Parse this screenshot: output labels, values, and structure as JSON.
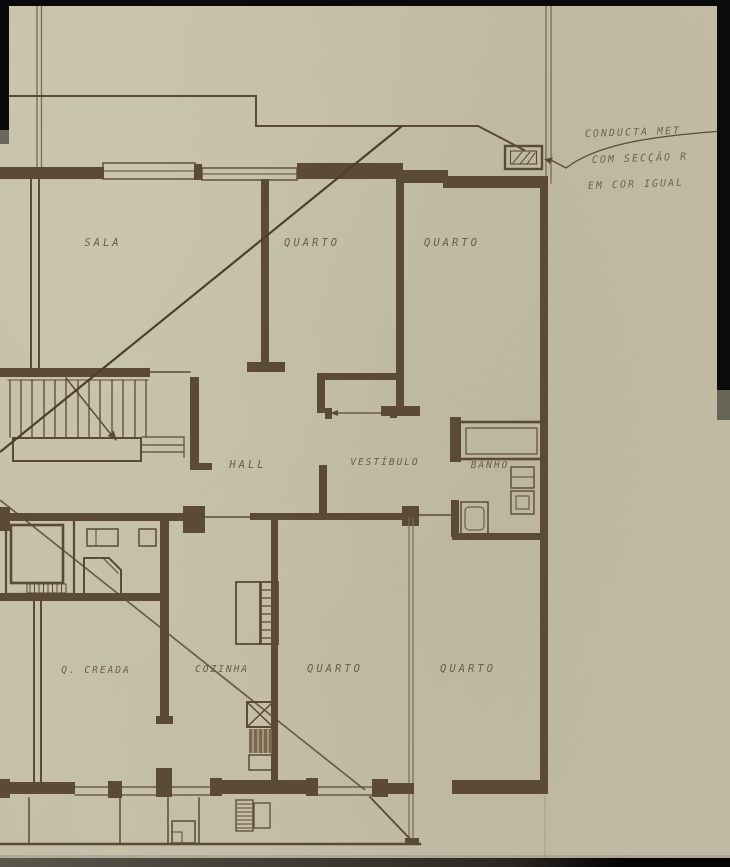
{
  "drawing": {
    "annotation": {
      "line1": "CONDUCTA MET",
      "line2": "COM SECÇÃO R",
      "line3": "EM COR IGUAL"
    },
    "rooms_upper": {
      "sala": "SALA",
      "quarto1": "QUARTO",
      "quarto2": "QUARTO",
      "hall": "HALL",
      "vestibulo": "VESTÍBULO",
      "banho": "BANHO"
    },
    "rooms_lower": {
      "creada": "Q. CREADA",
      "cozinha": "COZINHA",
      "quarto3": "QUARTO",
      "quarto4": "QUARTO"
    },
    "colors": {
      "paper": "#c5bfa8",
      "ink": "#5a4a36",
      "ink_light": "#7b6b53",
      "edge_black": "#0b0b0b"
    }
  }
}
